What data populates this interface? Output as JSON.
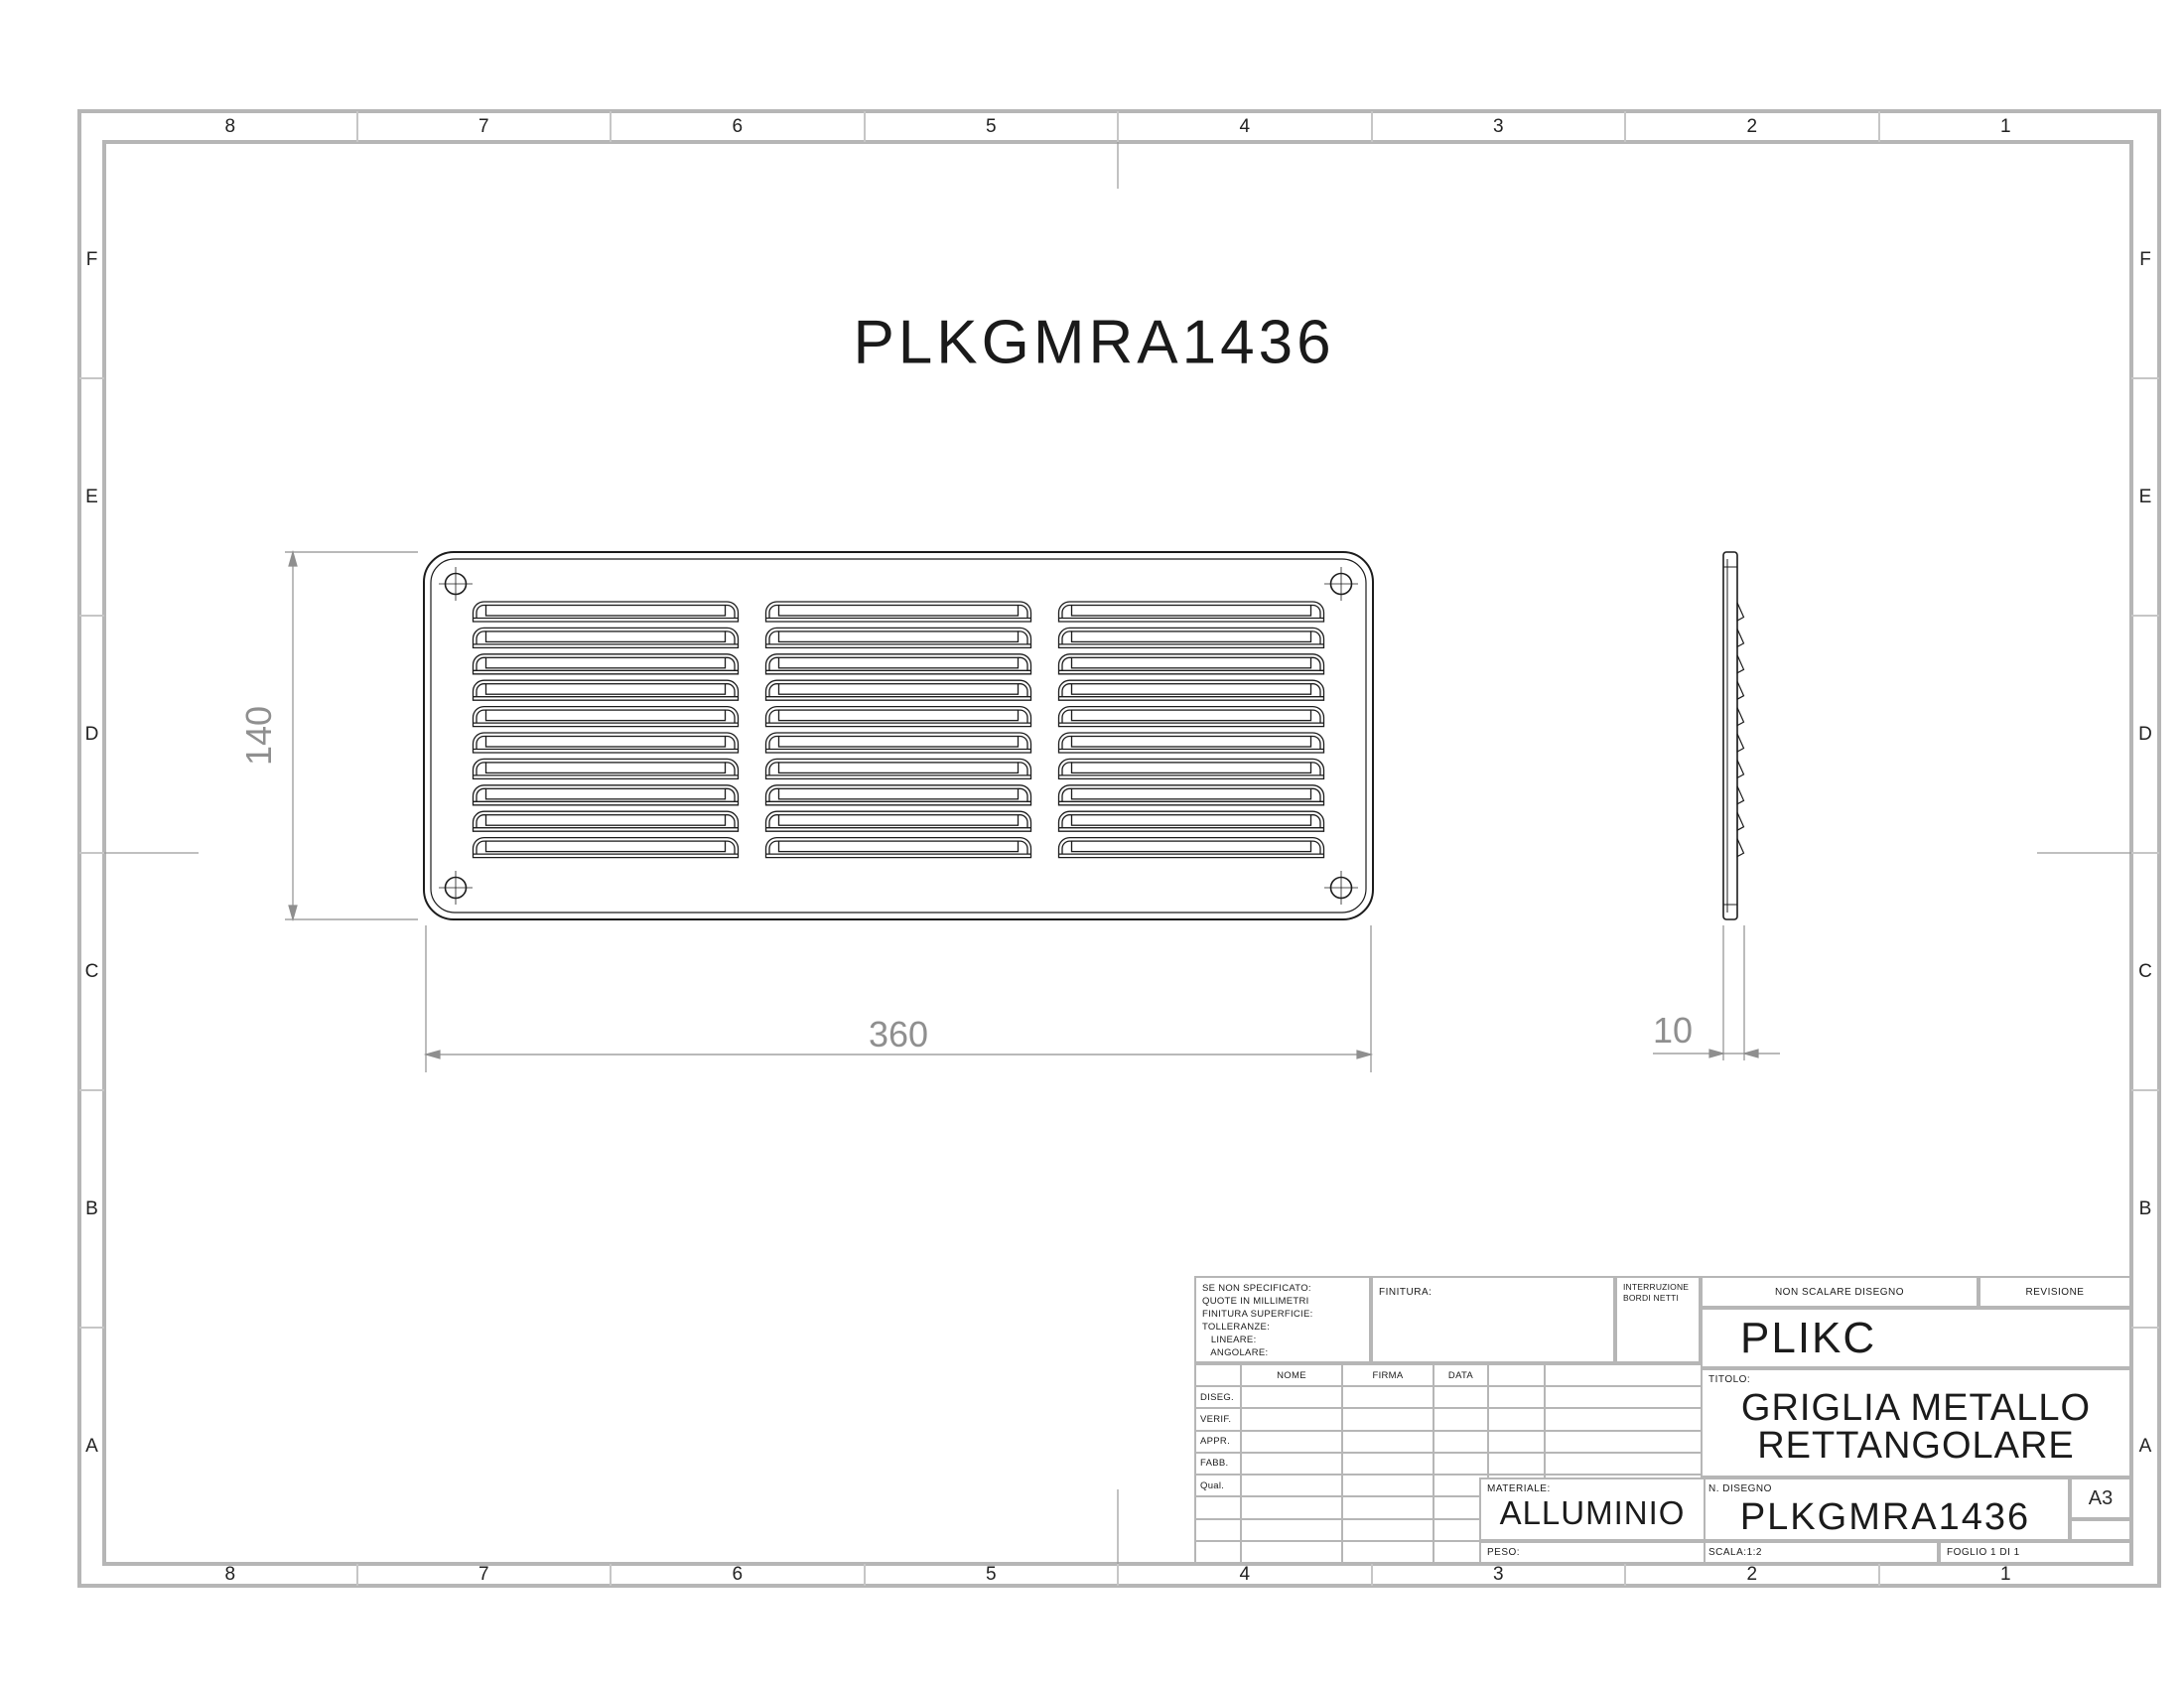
{
  "sheet": {
    "big_title": "PLKGMRA1436",
    "grid_columns": [
      "8",
      "7",
      "6",
      "5",
      "4",
      "3",
      "2",
      "1"
    ],
    "grid_rows": [
      "F",
      "E",
      "D",
      "C",
      "B",
      "A"
    ]
  },
  "views": {
    "front": {
      "louver_columns": 3,
      "louver_rows": 10,
      "screw_count": 4
    },
    "side": {
      "tab_rows": 10
    }
  },
  "dimensions": {
    "height": "140",
    "width": "360",
    "depth": "10"
  },
  "title_block": {
    "tolerances": [
      "SE NON SPECIFICATO:",
      "QUOTE IN MILLIMETRI",
      "FINITURA SUPERFICIE:",
      "TOLLERANZE:",
      "   LINEARE:",
      "   ANGOLARE:"
    ],
    "finitura_label": "FINITURA:",
    "deburr_lines": [
      "INTERRUZIONE",
      "BORDI NETTI"
    ],
    "non_scalare": "NON SCALARE DISEGNO",
    "revisione_label": "REVISIONE",
    "company": "PLIKC",
    "titolo_label": "TITOLO:",
    "title_line1": "GRIGLIA METALLO",
    "title_line2": "RETTANGOLARE",
    "table": {
      "headers": [
        "NOME",
        "FIRMA",
        "DATA"
      ],
      "row_labels": [
        "DISEG.",
        "VERIF.",
        "APPR.",
        "FABB.",
        "Qual.",
        "",
        "",
        ""
      ]
    },
    "materiale_label": "MATERIALE:",
    "materiale_value": "ALLUMINIO",
    "peso_label": "PESO:",
    "n_disegno_label": "N. DISEGNO",
    "drawing_number": "PLKGMRA1436",
    "paper_size": "A3",
    "scala": "SCALA:1:2",
    "foglio": "FOGLIO 1 DI 1"
  },
  "colors": {
    "frame": "#b6b6b6",
    "dimension": "#8f8f8f",
    "line": "#1c1c1c"
  }
}
